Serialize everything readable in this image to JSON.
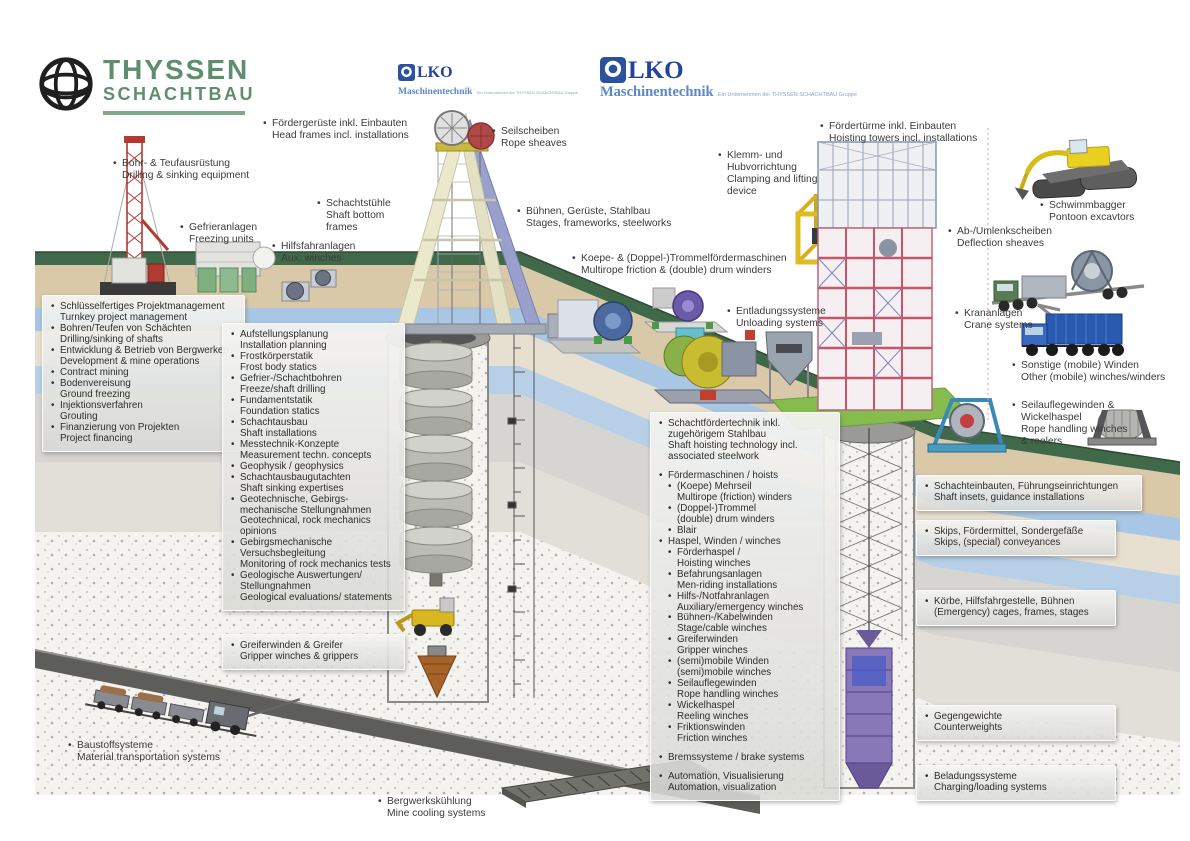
{
  "brand": {
    "thyssen": {
      "line1": "THYSSEN",
      "line2": "SCHACHTBAU"
    },
    "olko": {
      "wordmark": "LKO",
      "sub": "Maschinentechnik",
      "tagline": "Ein Unternehmen der THYSSEN SCHACHTBAU Gruppe"
    }
  },
  "colors": {
    "thyssen_green": "#5e8e6e",
    "olko_blue": "#24449c",
    "olko_light_blue": "#5b87c5",
    "surface_green": "#40694a",
    "bright_green": "#86bc4e",
    "strata_sand": "#d9c9a9",
    "strata_water": "#a9c7e4",
    "panel_bg": "#e4e4e0"
  },
  "labels": {
    "bohr": {
      "de": "Bohr- & Teufausrüstung",
      "en": "Drilling & sinking equipment"
    },
    "gefrier": {
      "de": "Gefrieranlagen",
      "en": "Freezing units"
    },
    "foerdergerueste": {
      "de": "Fördergerüste inkl. Einbauten",
      "en": "Head frames incl. installations"
    },
    "schachtstuehle": {
      "de": "Schachtstühle",
      "en": "Shaft bottom frames"
    },
    "hilfsfahr": {
      "de": "Hilfsfahranlagen",
      "en": "Aux. winches"
    },
    "seilscheiben": {
      "de": "Seilscheiben",
      "en": "Rope sheaves"
    },
    "buehnen": {
      "de": "Bühnen, Gerüste, Stahlbau",
      "en": "Stages, frameworks, steelworks"
    },
    "koepe": {
      "de": "Koepe- & (Doppel-)Trommelfördermaschinen",
      "en": "Multirope friction & (double) drum winders"
    },
    "klemm": {
      "de": "Klemm- und Hubvorrichtung",
      "en": "Clamping and lifting device"
    },
    "foerdertuerme": {
      "de": "Fördertürme inkl. Einbauten",
      "en": "Hoisting towers incl. installations"
    },
    "schwimmbagger": {
      "de": "Schwimmbagger",
      "en": "Pontoon excavtors"
    },
    "ablenk": {
      "de": "Ab-/Umlenkscheiben",
      "en": "Deflection sheaves"
    },
    "kran": {
      "de": "Krananlagen",
      "en": "Crane systems"
    },
    "sonstige": {
      "de": "Sonstige (mobile) Winden",
      "en": "Other (mobile) winches/winders"
    },
    "seilauflege": {
      "de": "Seilauflegewinden & Wickelhaspel",
      "en": "Rope handling winches & reelers"
    },
    "entladung": {
      "de": "Entladungssysteme",
      "en": "Unloading systems"
    },
    "baustoff": {
      "de": "Baustoffsysteme",
      "en": "Material transportation systems"
    },
    "bergwerk": {
      "de": "Bergwerkskühlung",
      "en": "Mine cooling systems"
    }
  },
  "panels": {
    "services": [
      {
        "de": "Schlüsselfertiges Projektmanagement",
        "en": "Turnkey project management"
      },
      {
        "de": "Bohren/Teufen von Schächten",
        "en": "Drilling/sinking of shafts"
      },
      {
        "de": "Entwicklung & Betrieb von Bergwerken",
        "en": "Development & mine operations"
      },
      {
        "de": "Contract mining",
        "en": ""
      },
      {
        "de": "Bodenvereisung",
        "en": "Ground freezing"
      },
      {
        "de": "Injektionsverfahren",
        "en": "Grouting"
      },
      {
        "de": "Finanzierung von Projekten",
        "en": "Project financing"
      }
    ],
    "engineering": [
      {
        "de": "Aufstellungsplanung",
        "en": "Installation planning"
      },
      {
        "de": "Frostkörperstatik",
        "en": "Frost body statics"
      },
      {
        "de": "Gefrier-/Schachtbohren",
        "en": "Freeze/shaft drilling"
      },
      {
        "de": "Fundamentstatik",
        "en": "Foundation statics"
      },
      {
        "de": "Schachtausbau",
        "en": "Shaft installations"
      },
      {
        "de": "Messtechnik-Konzepte",
        "en": "Measurement techn. concepts"
      },
      {
        "de": "Geophysik / geophysics",
        "en": ""
      },
      {
        "de": "Schachtausbaugutachten",
        "en": "Shaft sinking expertises"
      },
      {
        "de": "Geotechnische, Gebirgs- mechanische Stellungnahmen",
        "en": "Geotechnical, rock mechanics opinions"
      },
      {
        "de": "Gebirgsmechanische Versuchsbegleitung",
        "en": "Monitoring of rock mechanics tests"
      },
      {
        "de": "Geologische Auswertungen/ Stellungnahmen",
        "en": "Geological evaluations/ statements"
      }
    ],
    "gripper": [
      {
        "de": "Greiferwinden & Greifer",
        "en": "Gripper winches & grippers"
      }
    ],
    "hoisting": [
      {
        "de": "Schachtfördertechnik inkl. zugehörigem Stahlbau",
        "en": "Shaft hoisting technology incl. associated steelwork"
      },
      {
        "de": "Fördermaschinen / hoists",
        "en": "",
        "gap": true
      },
      {
        "de": "(Koepe) Mehrseil",
        "en": "Multirope (friction) winders",
        "level": 1
      },
      {
        "de": "(Doppel-)Trommel",
        "en": "(double) drum winders",
        "level": 1
      },
      {
        "de": "Blair",
        "en": "",
        "level": 1
      },
      {
        "de": "Haspel, Winden / winches",
        "en": ""
      },
      {
        "de": "Förderhaspel /",
        "en": "Hoisting winches",
        "level": 1
      },
      {
        "de": "Befahrungsanlagen",
        "en": "Men-riding installations",
        "level": 1
      },
      {
        "de": "Hilfs-/Notfahranlagen",
        "en": "Auxiliary/emergency winches",
        "level": 1
      },
      {
        "de": "Bühnen-/Kabelwinden",
        "en": "Stage/cable winches",
        "level": 1
      },
      {
        "de": "Greiferwinden",
        "en": "Gripper winches",
        "level": 1
      },
      {
        "de": "(semi)mobile Winden",
        "en": "(semi)mobile winches",
        "level": 1
      },
      {
        "de": "Seilauflegewinden",
        "en": "Rope handling winches",
        "level": 1
      },
      {
        "de": "Wickelhaspel",
        "en": "Reeling winches",
        "level": 1
      },
      {
        "de": "Friktionswinden",
        "en": "Friction winches",
        "level": 1
      },
      {
        "de": "Bremssysteme / brake systems",
        "en": "",
        "gap": true
      },
      {
        "de": "Automation, Visualisierung",
        "en": "Automation, visualization",
        "gap": true
      }
    ],
    "shaft_insets": [
      {
        "de": "Schachteinbauten, Führungseinrichtungen",
        "en": "Shaft insets, guidance installations"
      }
    ],
    "skips": [
      {
        "de": "Skips, Fördermittel, Sondergefäße",
        "en": "Skips, (special) conveyances"
      }
    ],
    "cages": [
      {
        "de": "Körbe, Hilfsfahrgestelle, Bühnen",
        "en": "(Emergency) cages, frames, stages"
      }
    ],
    "counterweights": [
      {
        "de": "Gegengewichte",
        "en": "Counterweights"
      }
    ],
    "loading": [
      {
        "de": "Beladungssysteme",
        "en": "Charging/loading systems"
      }
    ]
  },
  "illustrations": [
    "drill-rig",
    "freezing-units",
    "aux-winches",
    "headframe",
    "koepe-winder",
    "unloading-machines",
    "clamping-device",
    "hoisting-tower",
    "pontoon-excavator",
    "sheave-transport-truck",
    "crane-truck",
    "blue-winch",
    "rope-reel-winch",
    "sinking-stage",
    "shaft-loader",
    "shaft-drill-bit",
    "shaft-cage",
    "mine-train",
    "mine-cooling-unit"
  ]
}
